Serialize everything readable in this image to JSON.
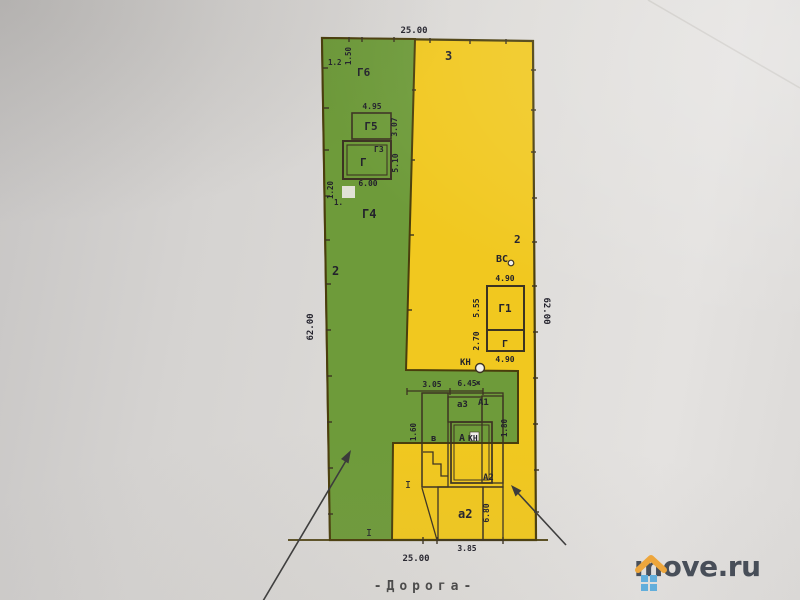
{
  "colors": {
    "green": "#6e9b3a",
    "yellow": "#f1c81f",
    "boundary": "#4a3e0c",
    "building_line": "#3c3322",
    "label_ink": "#23222c",
    "paper": "#dedcd9",
    "road_ink": "#474747"
  },
  "dims": {
    "top_width": "25.00",
    "left_height": "62.00",
    "right_height": "62.00",
    "g6_offset_a": "1.2",
    "g6_offset_b": "1.50",
    "g5_width": "4.95",
    "g5_depth": "3.07",
    "g_depth": "5.10",
    "g_width": "6.00",
    "edge": "1.20",
    "edge_mark": "1.",
    "g1_width_top": "4.90",
    "g1_depth": "5.55",
    "g_small_depth": "2.70",
    "g1_width_bottom": "4.90",
    "house_left": "3.05",
    "house_right": "6.45",
    "house_depth_left": "1.60",
    "house_depth_right": "1.80",
    "a2_depth": "6.80",
    "bottom_width": "25.00",
    "bottom_porch": "3.85"
  },
  "bld": {
    "g6": "Г6",
    "g5": "Г5",
    "g3": "Г3",
    "g": "Г",
    "g4": "Г4",
    "g1": "Г1",
    "g_small": "Г",
    "a": "А",
    "a1": "А1",
    "a2_upper": "А2",
    "a3": "а3",
    "a2_lower": "а2",
    "v": "в",
    "kn_top": "КН",
    "kn_inner": "КН",
    "vs": "ВС",
    "zh": "ж"
  },
  "zones": {
    "green": "2",
    "yellow": "2",
    "top": "3",
    "i1": "I",
    "i2": "I"
  },
  "road": "-Дорога-",
  "logo": {
    "text": "move.ru",
    "roof_color": "#f2a431",
    "window_color": "#58ade0",
    "ink_color": "#3d4550"
  }
}
